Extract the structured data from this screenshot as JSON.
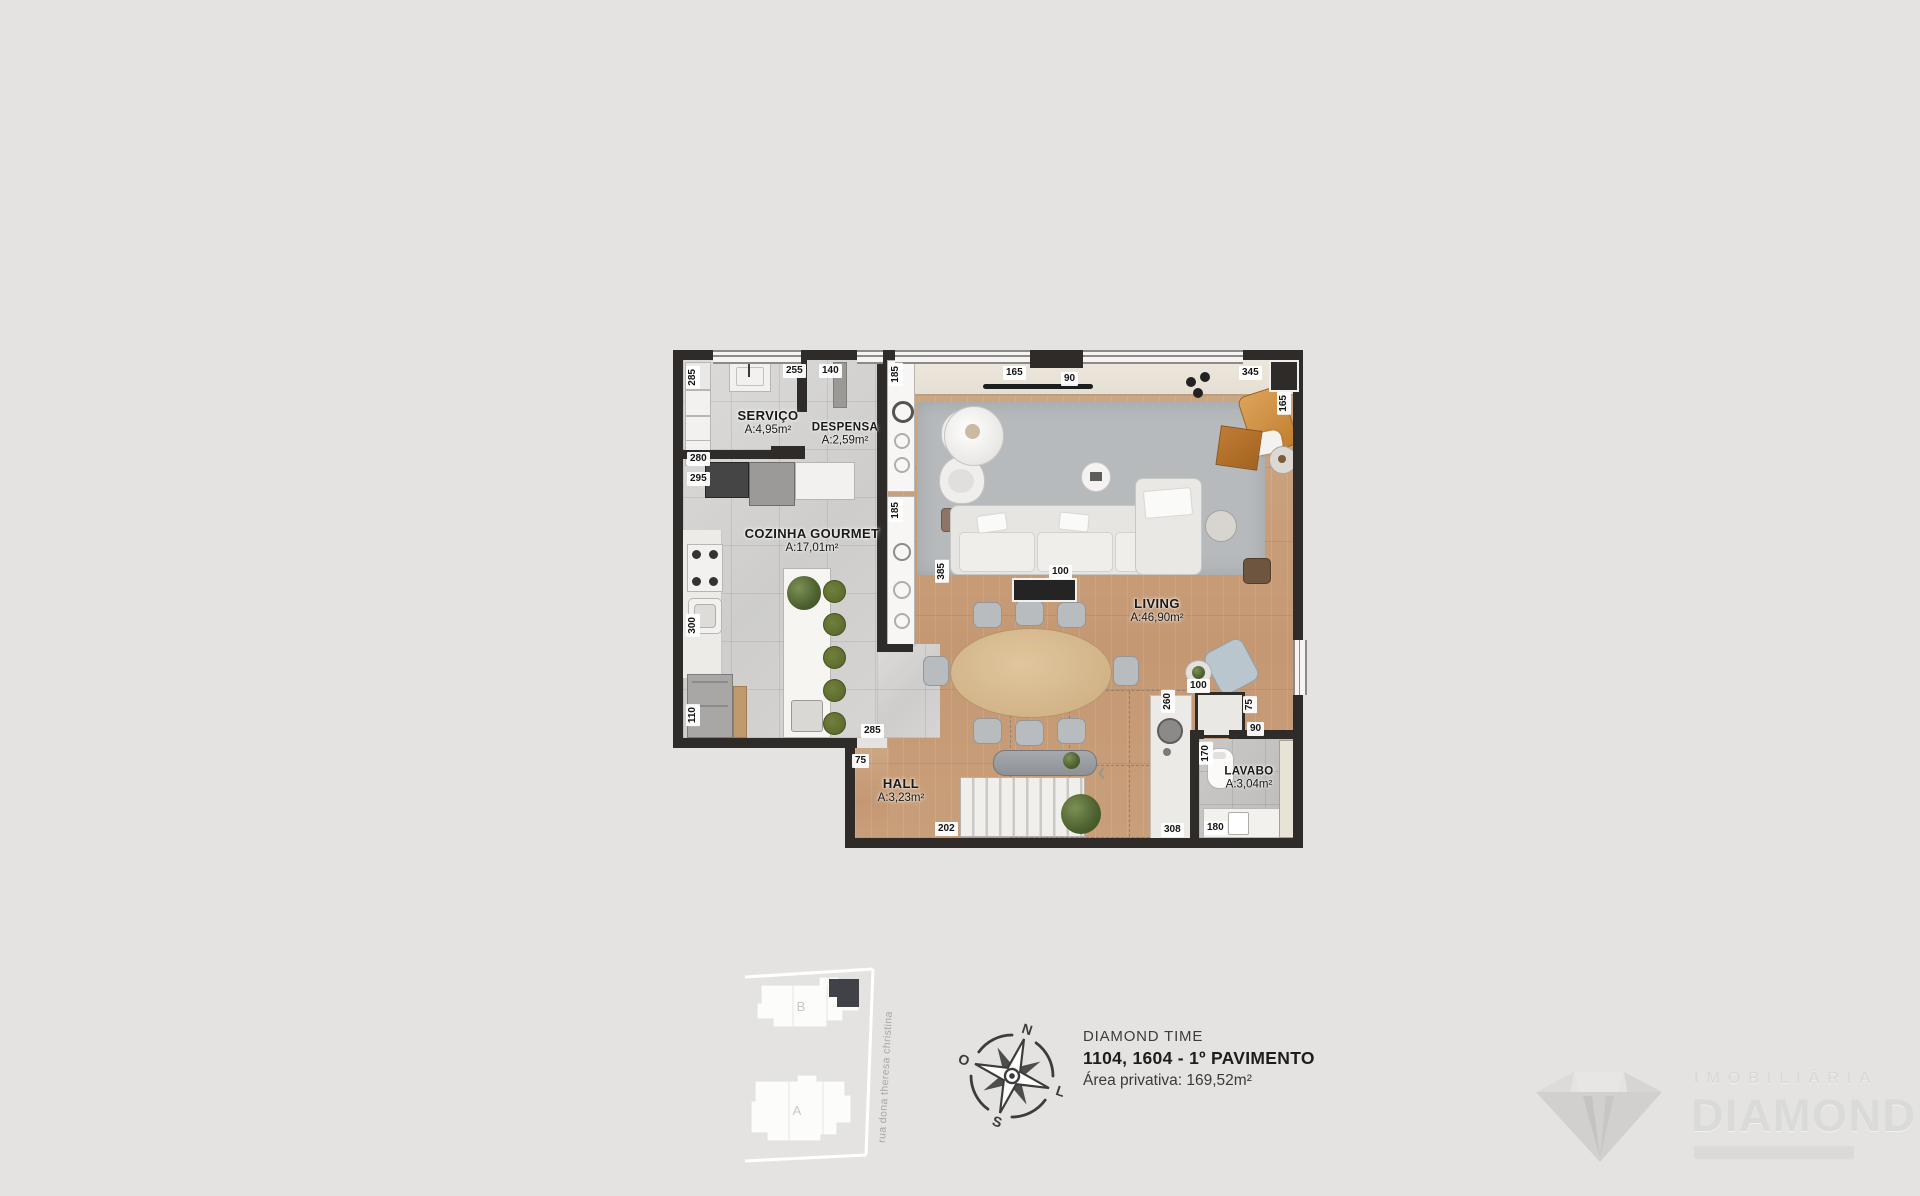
{
  "colors": {
    "background": "#e4e3e2",
    "wall": "#2e2b28",
    "wood_floor": "#c9a27c",
    "gray_floor": "#d4d3d1",
    "rug": "#b7babc",
    "stool_green": "#5f6d2f",
    "lounge_tan": "#d0913f",
    "highlight_unit": "#404247"
  },
  "plan": {
    "rooms": {
      "servico": {
        "name": "SERVIÇO",
        "area": "A:4,95m²"
      },
      "despensa": {
        "name": "DESPENSA",
        "area": "A:2,59m²"
      },
      "cozinha": {
        "name": "COZINHA GOURMET",
        "area": "A:17,01m²"
      },
      "living": {
        "name": "LIVING",
        "area": "A:46,90m²"
      },
      "hall": {
        "name": "HALL",
        "area": "A:3,23m²"
      },
      "lavabo": {
        "name": "LAVABO",
        "area": "A:3,04m²"
      }
    },
    "dims": {
      "top_255": "255",
      "top_140": "140",
      "top_165": "165",
      "top_90": "90",
      "top_345": "345",
      "right_165": "165",
      "left_285": "285",
      "left_280": "280",
      "left_295": "295",
      "left_300": "300",
      "left_110": "110",
      "shaft_185_a": "185",
      "shaft_185_b": "185",
      "living_385": "385",
      "sofa_100": "100",
      "chair_100": "100",
      "bar_260": "260",
      "closet_75": "75",
      "closet_90": "90",
      "lavabo_170": "170",
      "kitchen_285": "285",
      "hall_75": "75",
      "bottom_202": "202",
      "bottom_308": "308",
      "bottom_180": "180"
    }
  },
  "key_plan": {
    "tower_b": "B",
    "tower_a": "A",
    "street": "rua dona theresa christina"
  },
  "compass": {
    "n": "N",
    "s": "S",
    "e": "L",
    "w": "O"
  },
  "info": {
    "project": "DIAMOND TIME",
    "unit": "1104, 1604 - 1º PAVIMENTO",
    "private_area": "Área privativa: 169,52m²"
  },
  "logo": {
    "category": "IMOBILIÁRIA",
    "brand": "DIAMOND"
  }
}
